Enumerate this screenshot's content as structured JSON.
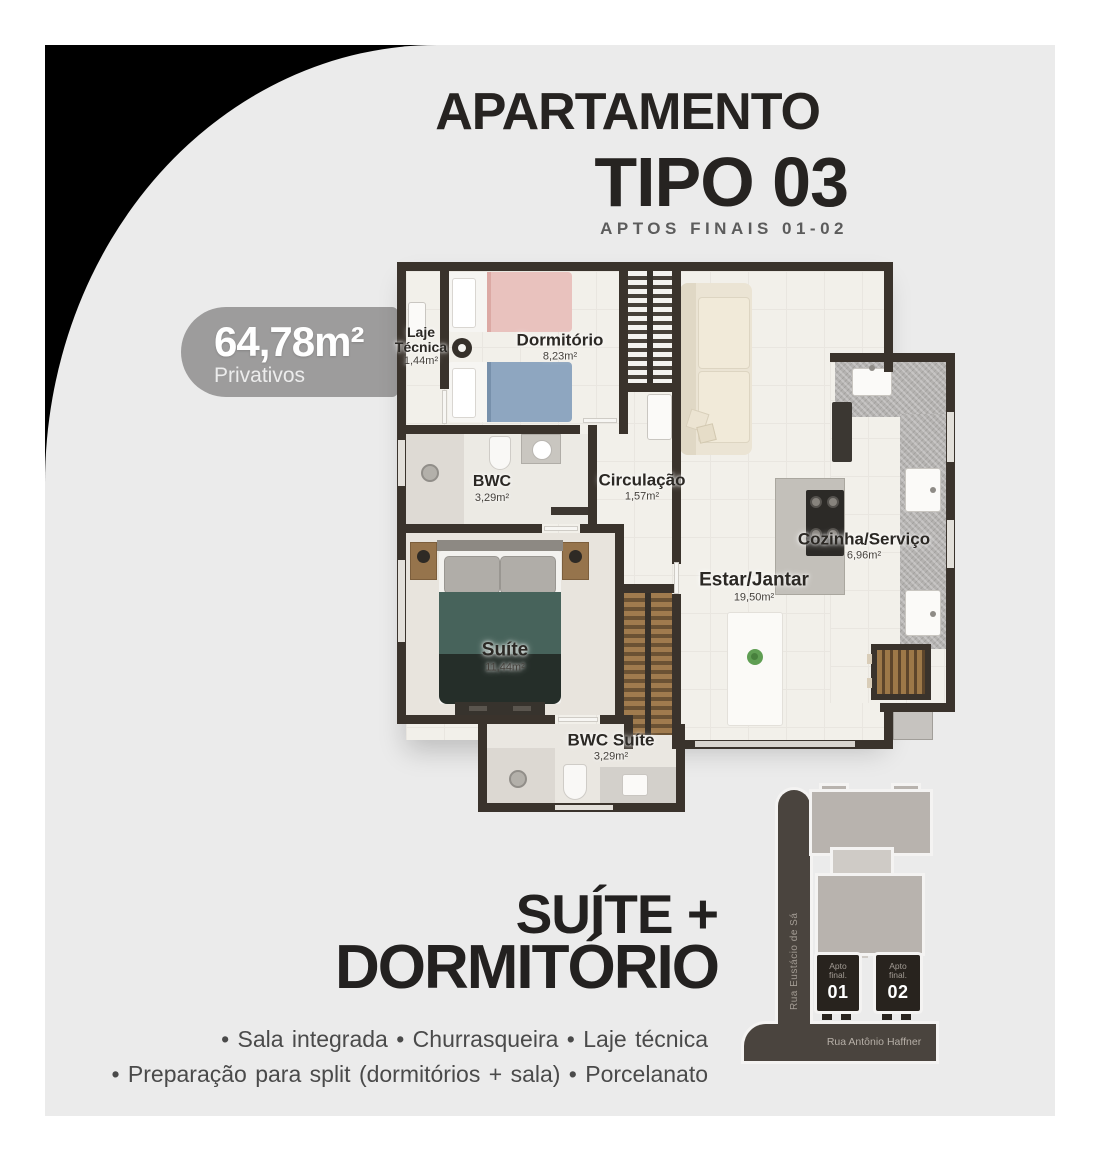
{
  "header": {
    "title": "APARTAMENTO",
    "type": "TIPO 03",
    "tagline": "APTOS FINAIS 01-02"
  },
  "badge": {
    "value": "64,78m²",
    "label": "Privativos"
  },
  "plan": {
    "rooms": [
      {
        "name": "Laje Técnica",
        "area": "1,44m²"
      },
      {
        "name": "Dormitório",
        "area": "8,23m²"
      },
      {
        "name": "BWC",
        "area": "3,29m²"
      },
      {
        "name": "Circulação",
        "area": "1,57m²"
      },
      {
        "name": "Suíte",
        "area": "11,44m²"
      },
      {
        "name": "Estar/Jantar",
        "area": "19,50m²"
      },
      {
        "name": "Cozinha/Serviço",
        "area": "6,96m²"
      },
      {
        "name": "BWC Suíte",
        "area": "3,29m²"
      }
    ]
  },
  "footer": {
    "headline1": "SUÍTE +",
    "headline2": "DORMITÓRIO",
    "features1": "•  Sala integrada   •  Churrasqueira   •  Laje técnica",
    "features2": "•  Preparação para split (dormitórios + sala)   •  Porcelanato"
  },
  "sitemap": {
    "street_vertical": "Rua Eustácio de Sá",
    "street_horizontal": "Rua Antônio Haffner",
    "units": [
      {
        "label": "Apto\nfinal.",
        "number": "01"
      },
      {
        "label": "Apto\nfinal.",
        "number": "02"
      }
    ]
  },
  "colors": {
    "background": "#ebebeb",
    "corner": "#000000",
    "badge": "#9d9c9c",
    "walls": "#3a332c",
    "street": "#4a443e"
  }
}
